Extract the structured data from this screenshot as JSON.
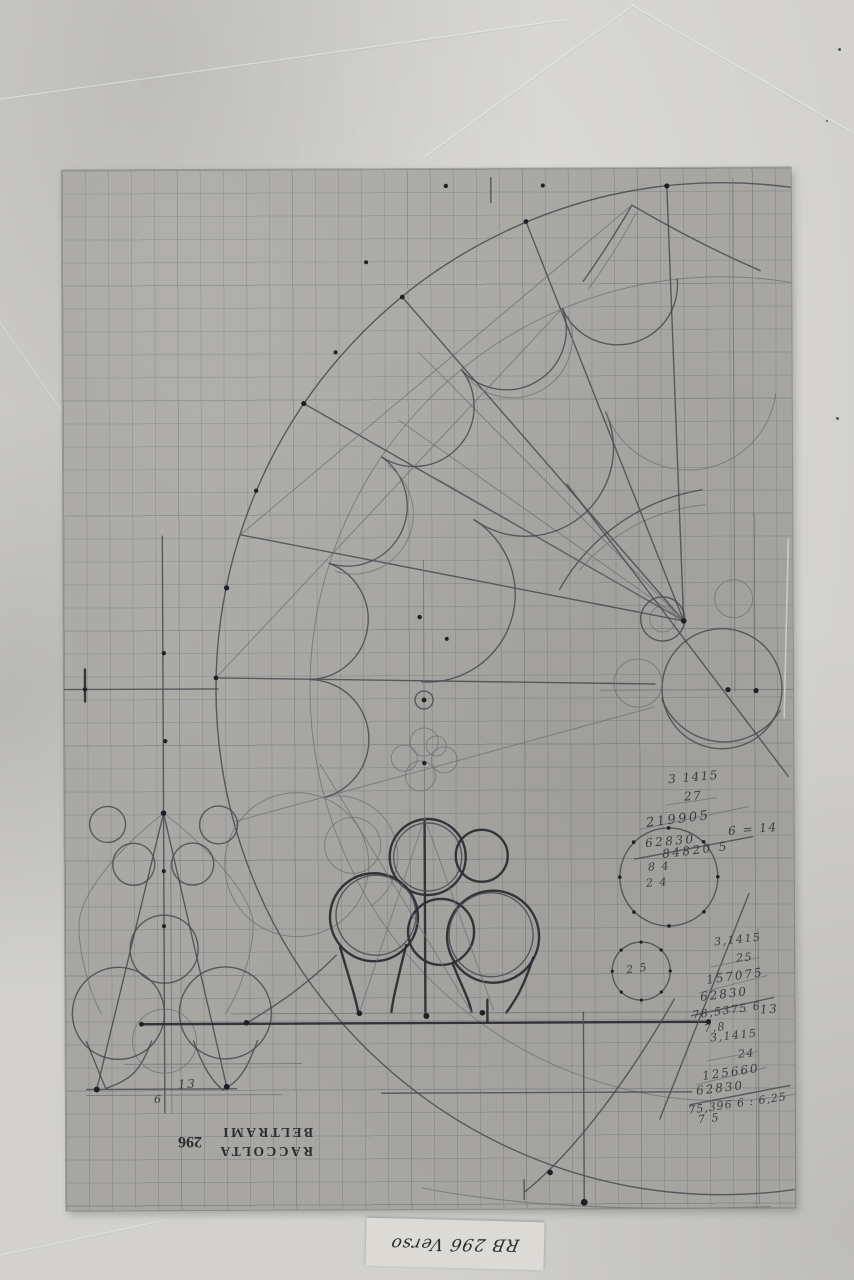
{
  "photo": {
    "description": "pencil construction drawing of a rose window on graph paper",
    "colors": {
      "mount": "#d2d1cd",
      "sheet": "#a7a6a2",
      "pencil": "#3a3a42",
      "slip": "#dbdad4"
    }
  },
  "stamp": {
    "line1": "RACCOLTA",
    "line2": "BELTRAMI",
    "number": "296"
  },
  "label_slip": {
    "text": "RB 296 Verso"
  },
  "annotations": {
    "calc1": {
      "lines": [
        "3 1415",
        "27",
        "219905",
        "62830",
        "84820 5"
      ]
    },
    "note_6_14": "6 = 14",
    "circle24_lines": [
      "8 4",
      "2 4"
    ],
    "circle25_text": "2 5",
    "calc2": {
      "lines": [
        "3,1415",
        "25",
        "157075",
        "62830",
        "78,5375 6"
      ]
    },
    "calc2_result": "7,8",
    "calc2_note": "13",
    "calc3": {
      "lines": [
        "3,1415",
        "24",
        "125660",
        "62830",
        "75,396 6 : 6,25"
      ]
    },
    "calc3_result": "7 5",
    "dim_13": "13",
    "dim_6": "6"
  }
}
